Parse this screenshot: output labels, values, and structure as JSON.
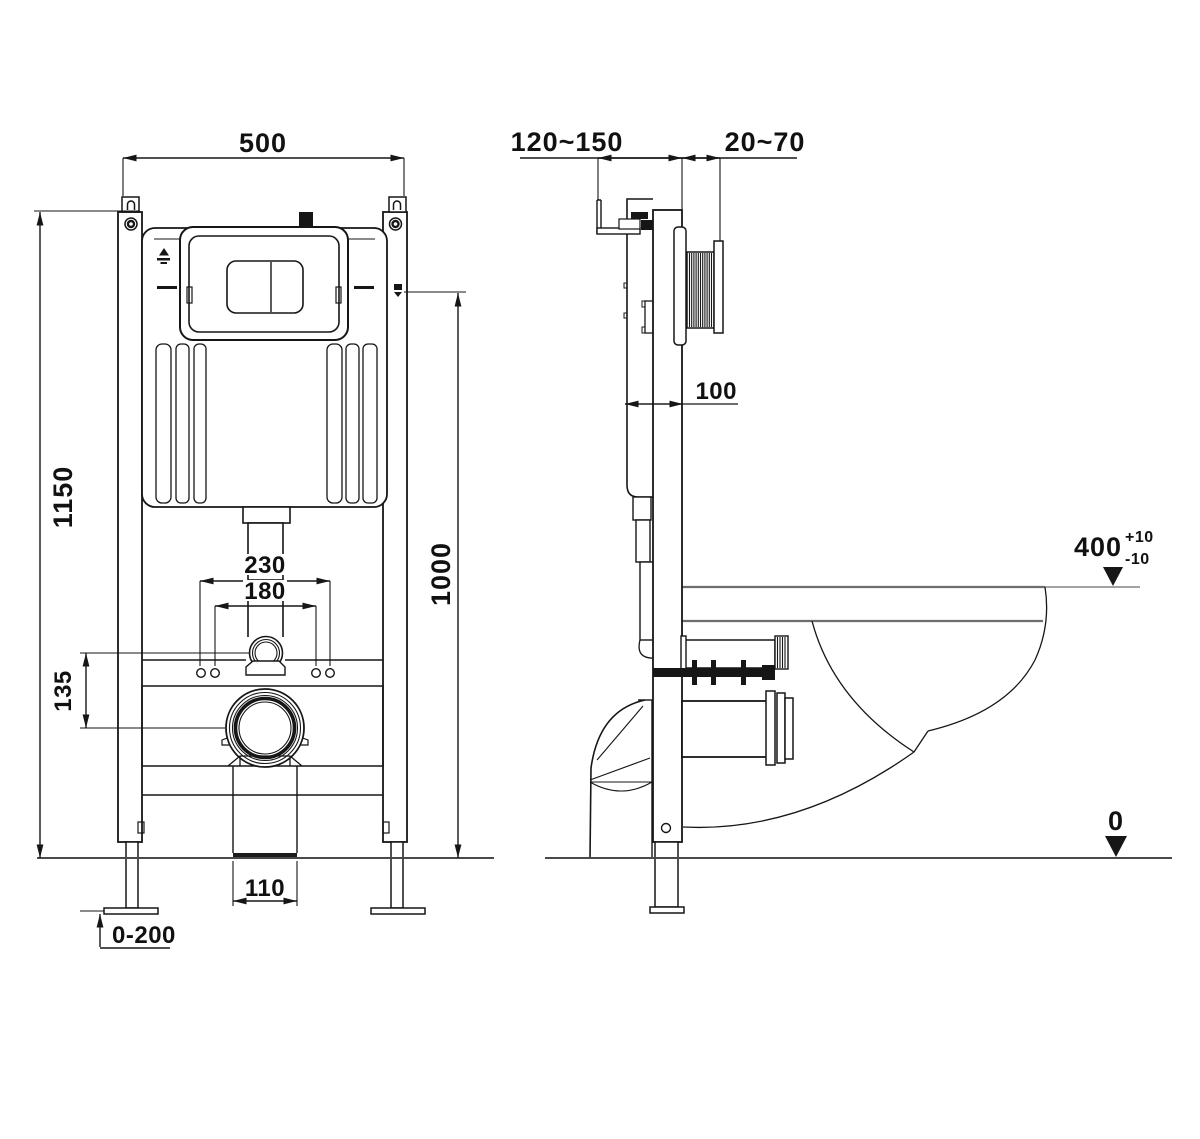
{
  "labels": {
    "front": {
      "overall_width": "500",
      "overall_height": "1150",
      "supply_height": "1000",
      "fixing_outer": "230",
      "fixing_inner": "180",
      "flush_to_drain": "135",
      "drain_outlet": "110",
      "foot_adjust": "0-200"
    },
    "side": {
      "frame_depth_range": "120~150",
      "wall_finish_range": "20~70",
      "cistern_depth": "100",
      "bowl_height": "400",
      "bowl_tol_plus": "+10",
      "bowl_tol_minus": "-10",
      "floor_level": "0"
    }
  },
  "colors": {
    "line": "#161616",
    "soft_line": "#6e6e6e",
    "floor": "#4a4a4a",
    "background": "#ffffff"
  }
}
